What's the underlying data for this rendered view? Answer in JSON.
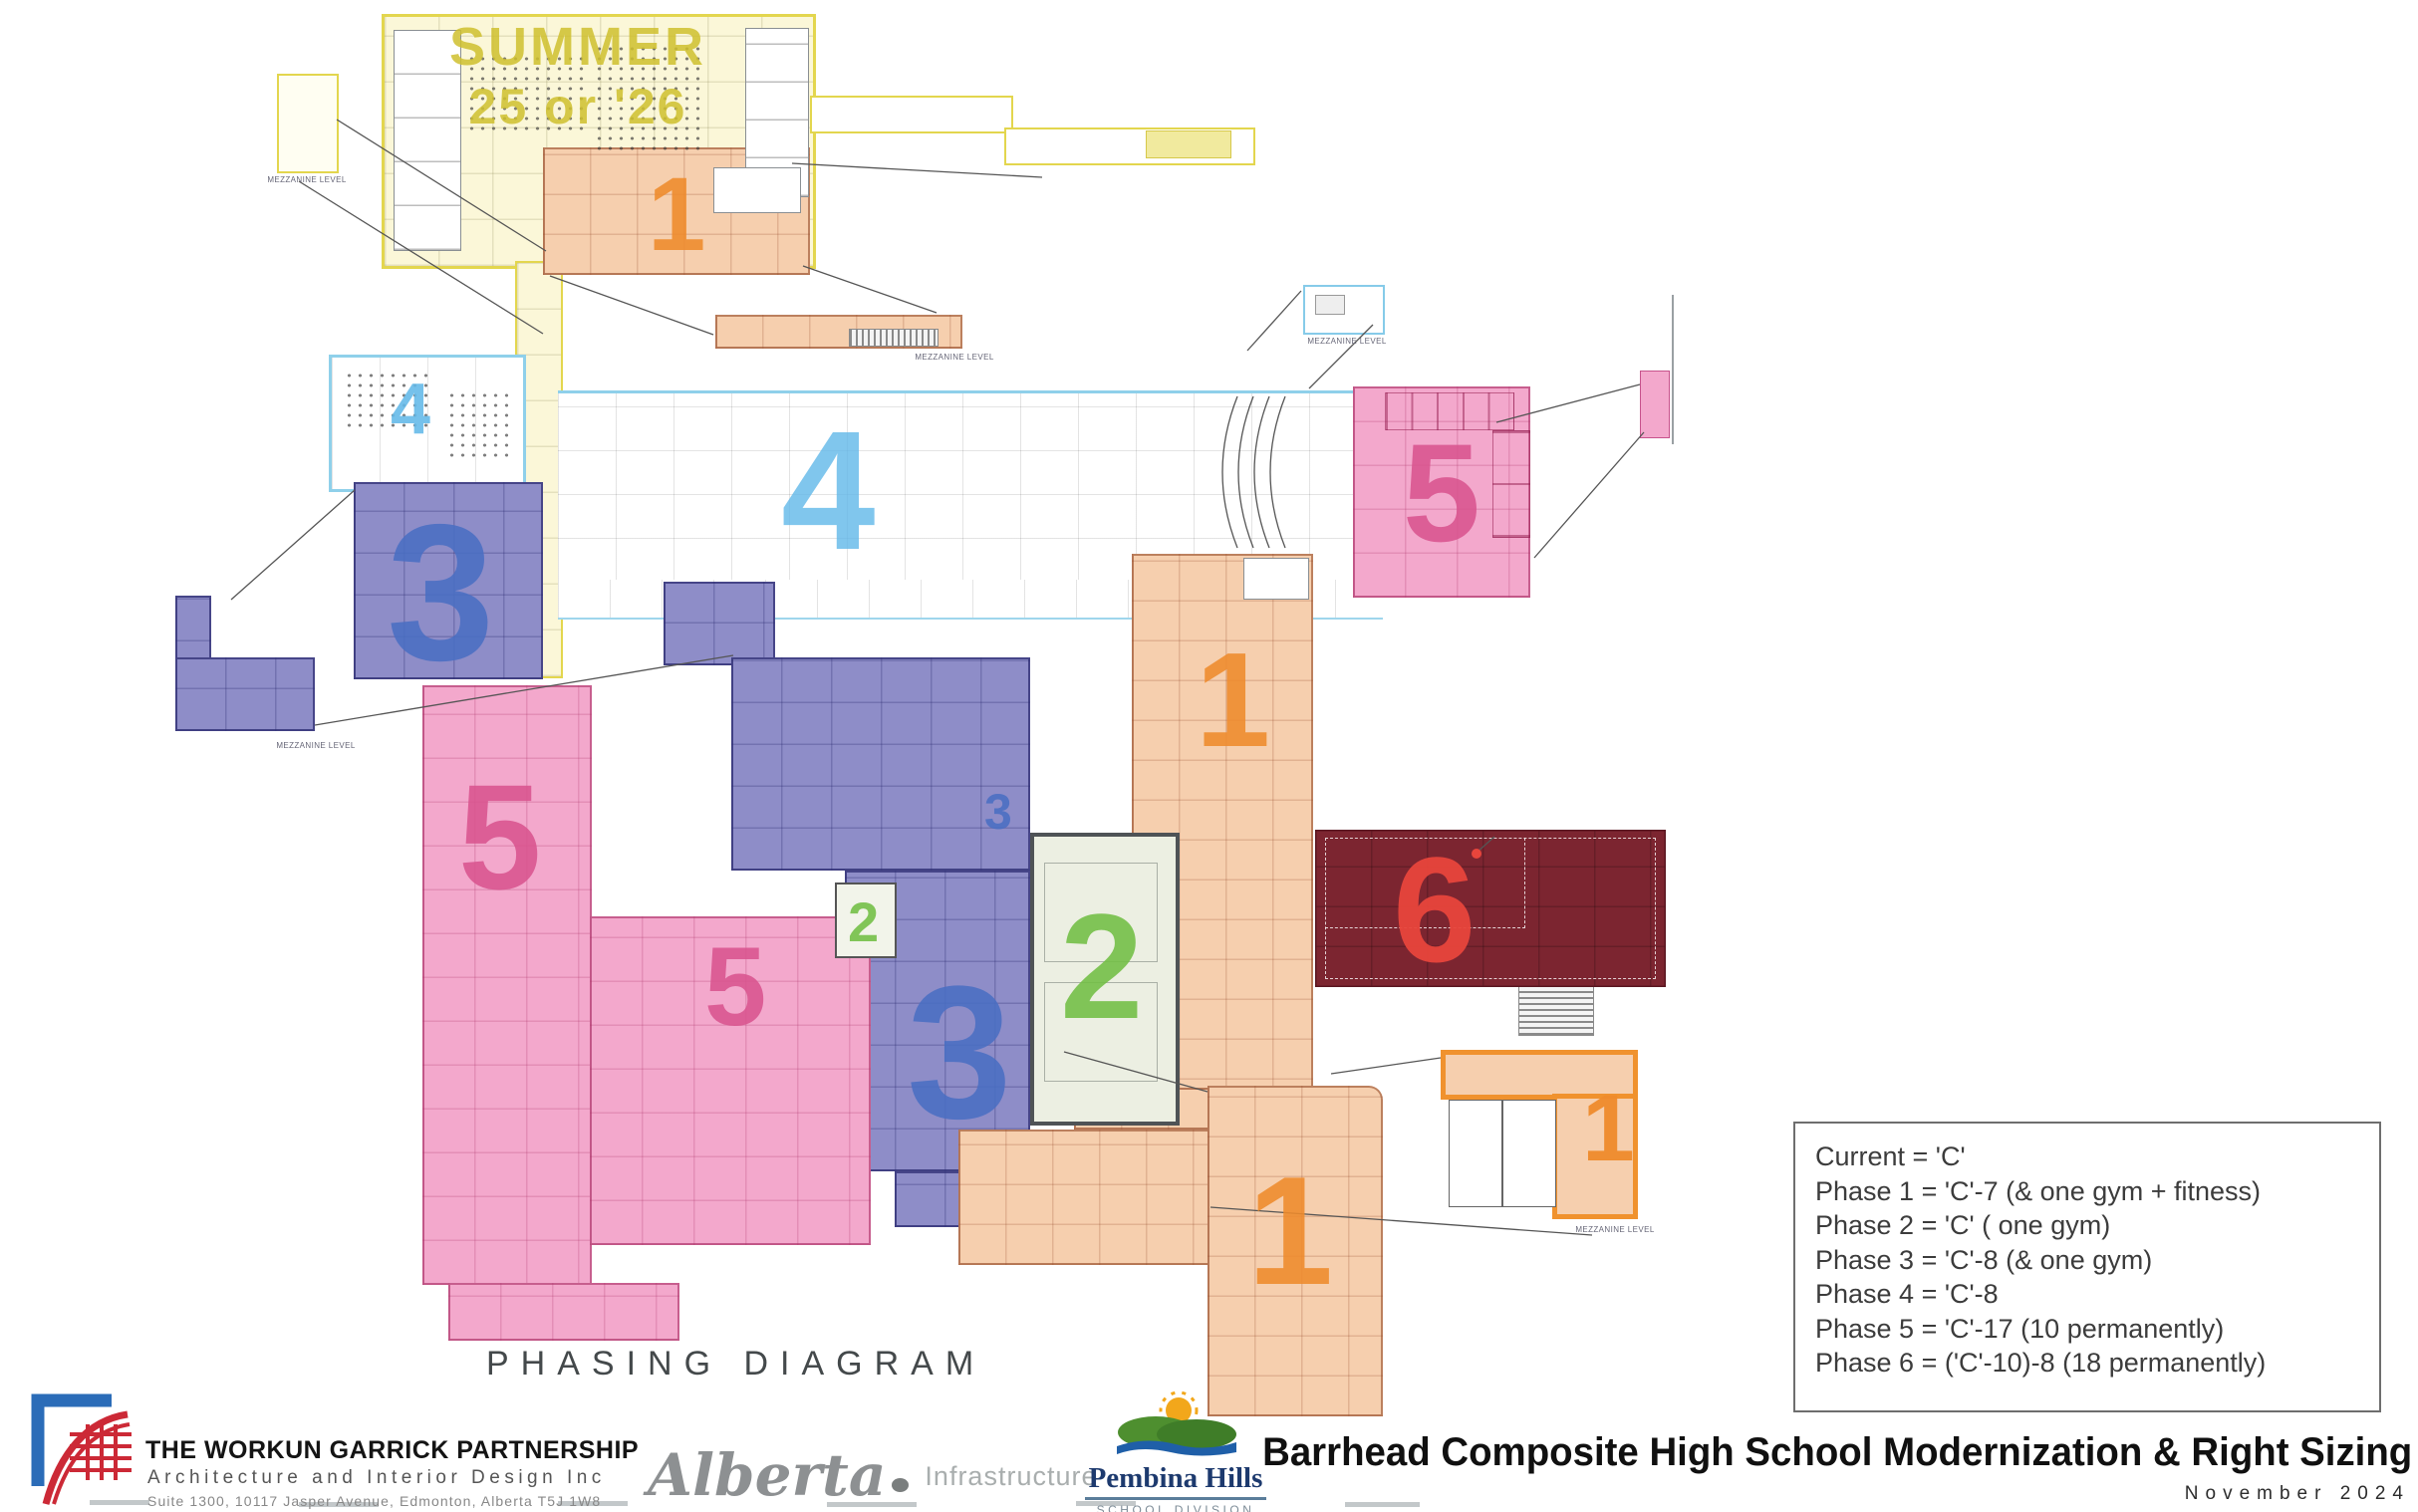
{
  "meta": {
    "drawing_label": "PHASING DIAGRAM"
  },
  "plan": {
    "summer": {
      "line1": "SUMMER",
      "line2": "25 or '26"
    },
    "mezzanine_caption": "MEZZANINE LEVEL"
  },
  "phases": {
    "p1": {
      "number": "1",
      "color": "#ef8b2c"
    },
    "p2": {
      "number": "2",
      "color": "#72bf44"
    },
    "p3": {
      "number": "3",
      "color": "#4a6fc3"
    },
    "p4": {
      "number": "4",
      "color": "#63b9e9"
    },
    "p5": {
      "number": "5",
      "color": "#d9548f"
    },
    "p6": {
      "number": "6",
      "color": "#e8453c"
    }
  },
  "legend": {
    "lines": [
      "Current = 'C'",
      "Phase 1 = 'C'-7 (& one gym + fitness)",
      "Phase 2 = 'C' ( one gym)",
      "Phase 3 = 'C'-8 (& one gym)",
      "Phase 4 = 'C'-8",
      "Phase 5 = 'C'-17 (10 permanently)",
      "Phase 6 = ('C'-10)-8 (18 permanently)"
    ]
  },
  "footer": {
    "firm": {
      "name": "THE WORKUN GARRICK PARTNERSHIP",
      "tagline": "Architecture and Interior Design Inc",
      "address": "Suite 1300, 10117 Jasper Avenue, Edmonton, Alberta T5J 1W8"
    },
    "alberta": {
      "wordmark": "Alberta",
      "suffix": "Infrastructure"
    },
    "pembina": {
      "name": "Pembina Hills",
      "division": "SCHOOL DIVISION"
    },
    "project_title": "Barrhead Composite High School Modernization & Right Sizing",
    "date": "November 2024"
  }
}
